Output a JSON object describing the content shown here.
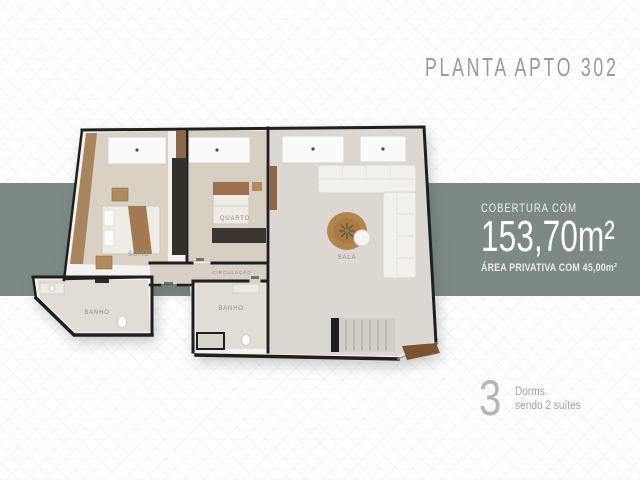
{
  "title": "PLANTA APTO 302",
  "info_panel": {
    "intro": "COBERTURA COM",
    "area_total": "153,70m²",
    "area_private": "ÁREA PRIVATIVA COM 45,00m²"
  },
  "summary": {
    "count": "3",
    "unit": "Dorms.",
    "detail": "sendo 2 suítes"
  },
  "floorplan": {
    "labels": {
      "suite": "SUÍTE",
      "quarto": "QUARTO",
      "sala": "SALA",
      "circulacao": "CIRCULAÇÃO",
      "banho1": "BANHO",
      "banho2": "BANHO"
    }
  },
  "colors": {
    "band": "#7d8a84",
    "title_text": "#9a9a9a",
    "panel_text": "#ffffff",
    "walls": "#1f1f1f",
    "wood": "#8a674a",
    "rug": "#b2854f"
  }
}
